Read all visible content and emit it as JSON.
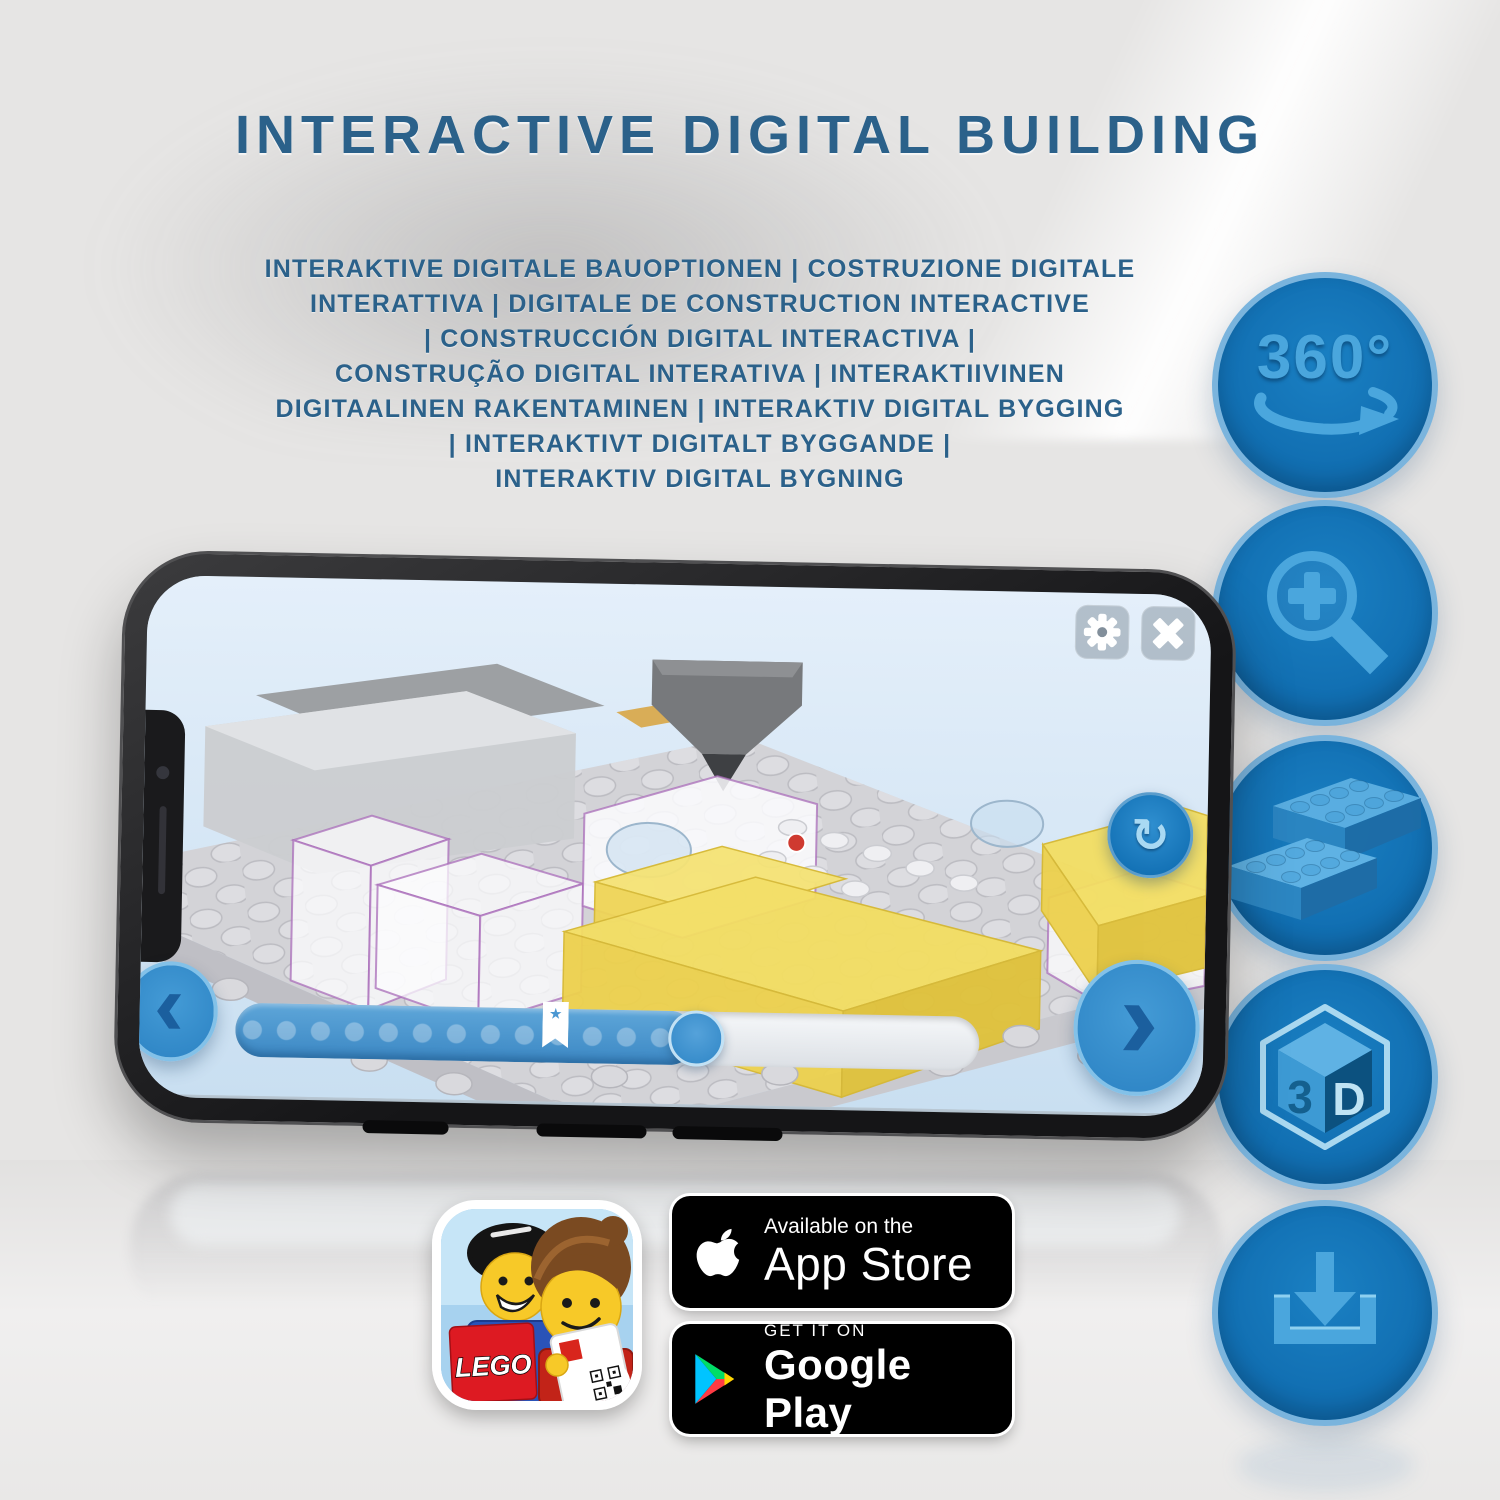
{
  "header": {
    "title": "INTERACTIVE DIGITAL BUILDING",
    "subtitle_lines": [
      "INTERAKTIVE DIGITALE BAUOPTIONEN | COSTRUZIONE DIGITALE",
      "INTERATTIVA | DIGITALE DE CONSTRUCTION INTERACTIVE",
      "| CONSTRUCCIÓN DIGITAL INTERACTIVA |",
      "CONSTRUÇÃO DIGITAL INTERATIVA | INTERAKTIIVINEN",
      "DIGITAALINEN RAKENTAMINEN | INTERAKTIV DIGITAL BYGGING",
      "| INTERAKTIVT DIGITALT BYGGANDE |",
      "INTERAKTIV DIGITAL BYGNING"
    ]
  },
  "features": {
    "rotation": {
      "label": "360°"
    },
    "cube": {
      "left": "3",
      "right": "D"
    }
  },
  "icons": {
    "star": "★",
    "rotate": "↻"
  },
  "store": {
    "lego_logo": "LEGO",
    "app_store": {
      "tagline": "Available on the",
      "name": "App Store"
    },
    "google_play": {
      "tagline": "GET IT ON",
      "name": "Google Play"
    }
  },
  "colors": {
    "title_blue": "#2b618a",
    "circle_blue": "#1173b9",
    "glyph_blue": "#4aa6dd",
    "app_accent": "#3c88c4",
    "badge_black": "#000000",
    "brick_yellow": "#f3de62"
  }
}
